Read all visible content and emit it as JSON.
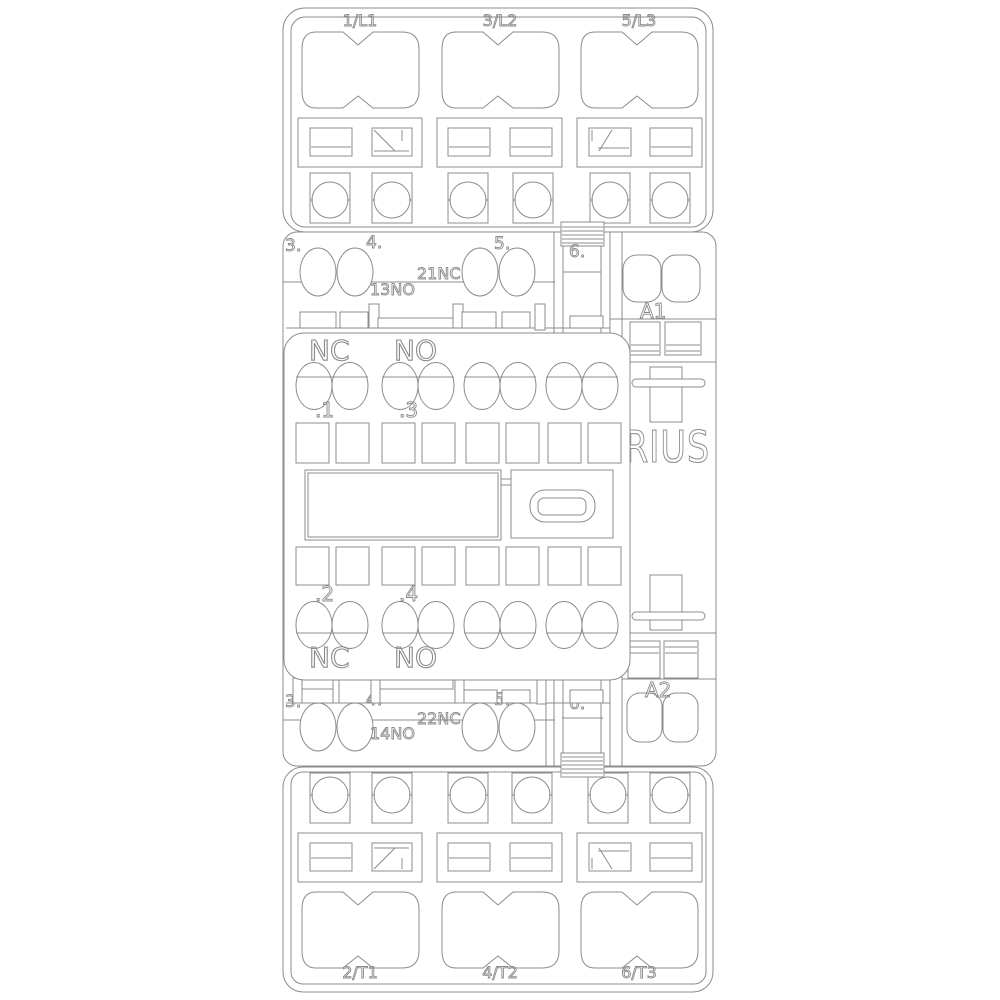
{
  "colors": {
    "line": "#8c8c8c",
    "background": "#ffffff"
  },
  "brand": {
    "label": "SIRIUS"
  },
  "power_input": {
    "terminals": [
      {
        "label": "1/L1"
      },
      {
        "label": "3/L2"
      },
      {
        "label": "5/L3"
      }
    ]
  },
  "power_output": {
    "terminals": [
      {
        "label": "2/T1"
      },
      {
        "label": "4/T2"
      },
      {
        "label": "6/T3"
      }
    ]
  },
  "aux_top": {
    "positions": [
      {
        "label": "3."
      },
      {
        "label": "4."
      },
      {
        "label": "5."
      },
      {
        "label": "6."
      }
    ],
    "no_terminal": "13NO",
    "nc_terminal": "21NC",
    "coil_terminal": "A1"
  },
  "aux_bottom": {
    "positions": [
      {
        "label": "3."
      },
      {
        "label": "4."
      },
      {
        "label": "5."
      },
      {
        "label": "6."
      }
    ],
    "no_terminal": "14NO",
    "nc_terminal": "22NC",
    "coil_terminal": "A2"
  },
  "front_aux_block": {
    "nc_top": "NC",
    "no_top": "NO",
    "contact_1": ".1",
    "contact_3": ".3",
    "contact_2": ".2",
    "contact_4": ".4",
    "nc_bottom": "NC",
    "no_bottom": "NO"
  }
}
